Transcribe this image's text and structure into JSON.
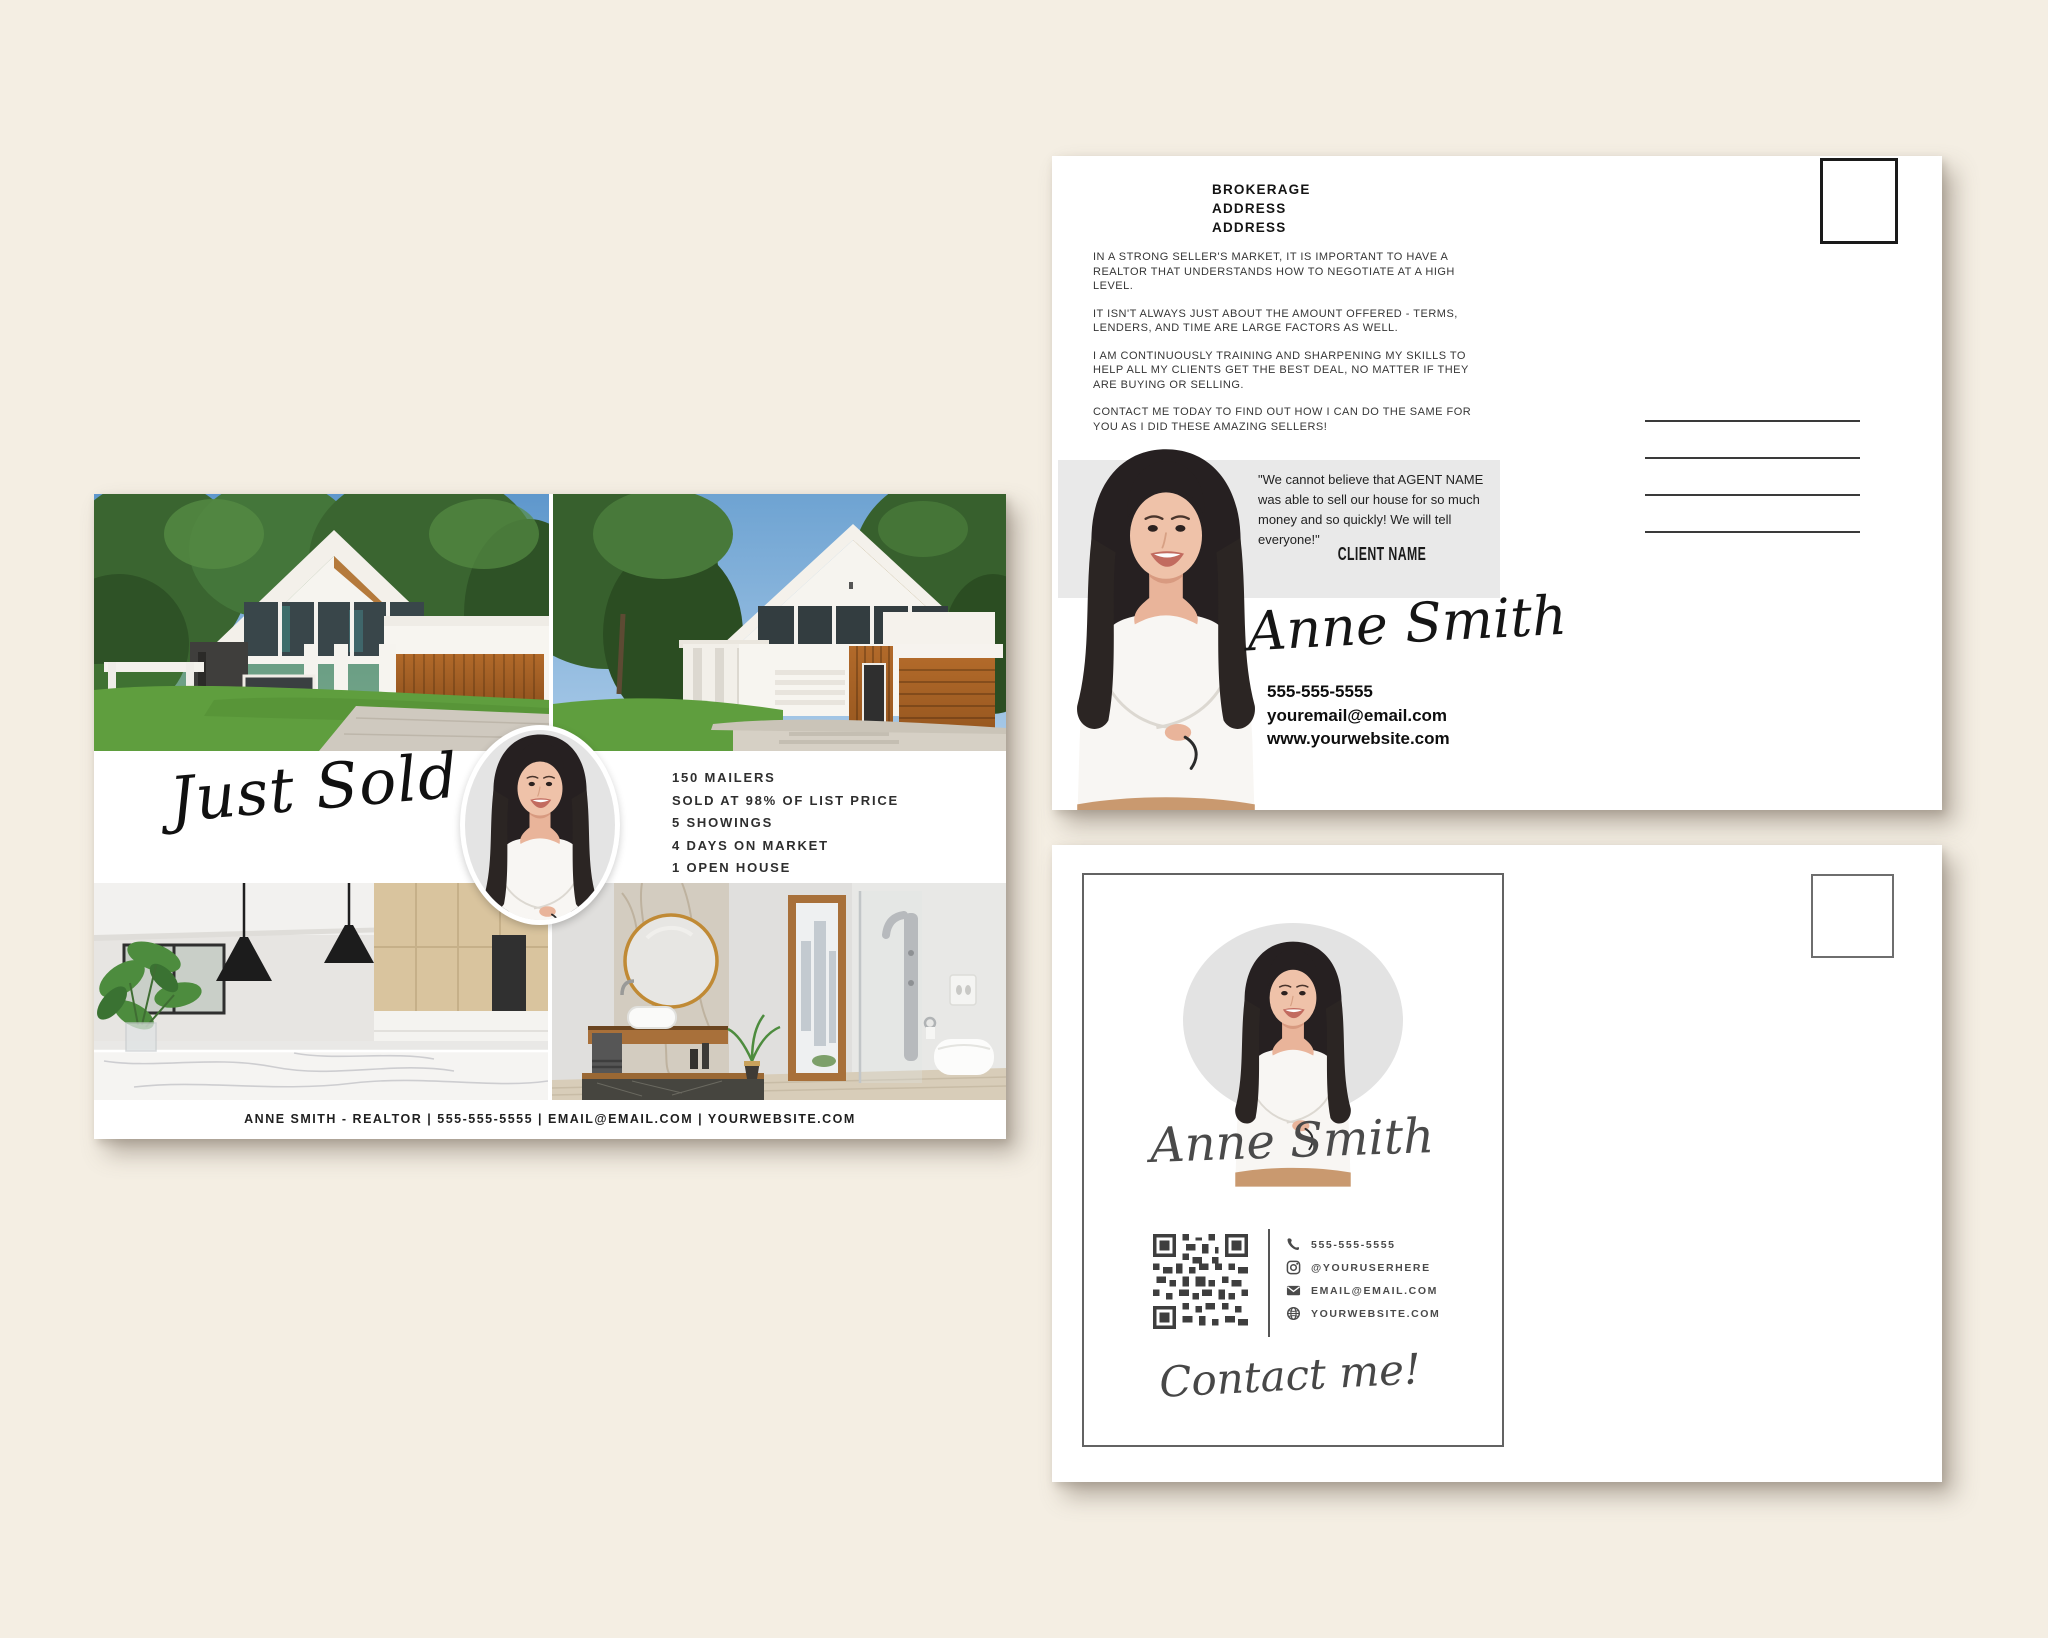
{
  "page": {
    "background": "#f4eee3"
  },
  "agent": {
    "name_script": "Anne Smith"
  },
  "front_card": {
    "title_script": "Just Sold",
    "stats": [
      "150 MAILERS",
      "SOLD AT 98% OF LIST PRICE",
      "5 SHOWINGS",
      "4 DAYS ON MARKET",
      "1 OPEN HOUSE"
    ],
    "footer": "ANNE SMITH - REALTOR | 555-555-5555 | EMAIL@EMAIL.COM | YOURWEBSITE.COM"
  },
  "back_card": {
    "brokerage_lines": [
      "BROKERAGE",
      "ADDRESS",
      "ADDRESS"
    ],
    "paragraphs": [
      "IN A STRONG SELLER'S MARKET, IT IS IMPORTANT TO HAVE A REALTOR THAT UNDERSTANDS HOW TO NEGOTIATE AT A HIGH LEVEL.",
      "IT ISN'T ALWAYS JUST ABOUT THE AMOUNT OFFERED - TERMS, LENDERS, AND TIME ARE LARGE FACTORS AS WELL.",
      "I AM CONTINUOUSLY TRAINING AND SHARPENING MY SKILLS TO HELP ALL MY CLIENTS GET THE BEST DEAL, NO MATTER IF THEY ARE BUYING OR SELLING.",
      "CONTACT ME TODAY TO FIND OUT HOW I CAN DO THE SAME FOR YOU AS I DID THESE AMAZING SELLERS!"
    ],
    "testimonial_quote": "\"We cannot believe that AGENT NAME was able to sell our house for so much money and so quickly! We will tell everyone!\"",
    "testimonial_client": "CLIENT NAME",
    "phone": "555-555-5555",
    "email": "youremail@email.com",
    "website": "www.yourwebsite.com"
  },
  "contact_card": {
    "rows": [
      {
        "icon": "phone-icon",
        "label": "555-555-5555"
      },
      {
        "icon": "instagram-icon",
        "label": "@YOURUSERHERE"
      },
      {
        "icon": "email-icon",
        "label": "EMAIL@EMAIL.COM"
      },
      {
        "icon": "globe-icon",
        "label": "YOURWEBSITE.COM"
      }
    ],
    "cta_script": "Contact me!"
  },
  "colors": {
    "background": "#f4eee3",
    "card": "#ffffff",
    "testimonial_band": "#e9e9e9",
    "photo_backdrop": "#e3e3e3",
    "wood_accent": "#b06a2a",
    "lawn_green": "#5f9e3e",
    "text_dark": "#1c1c1c",
    "text_grey": "#4a4a4a"
  }
}
